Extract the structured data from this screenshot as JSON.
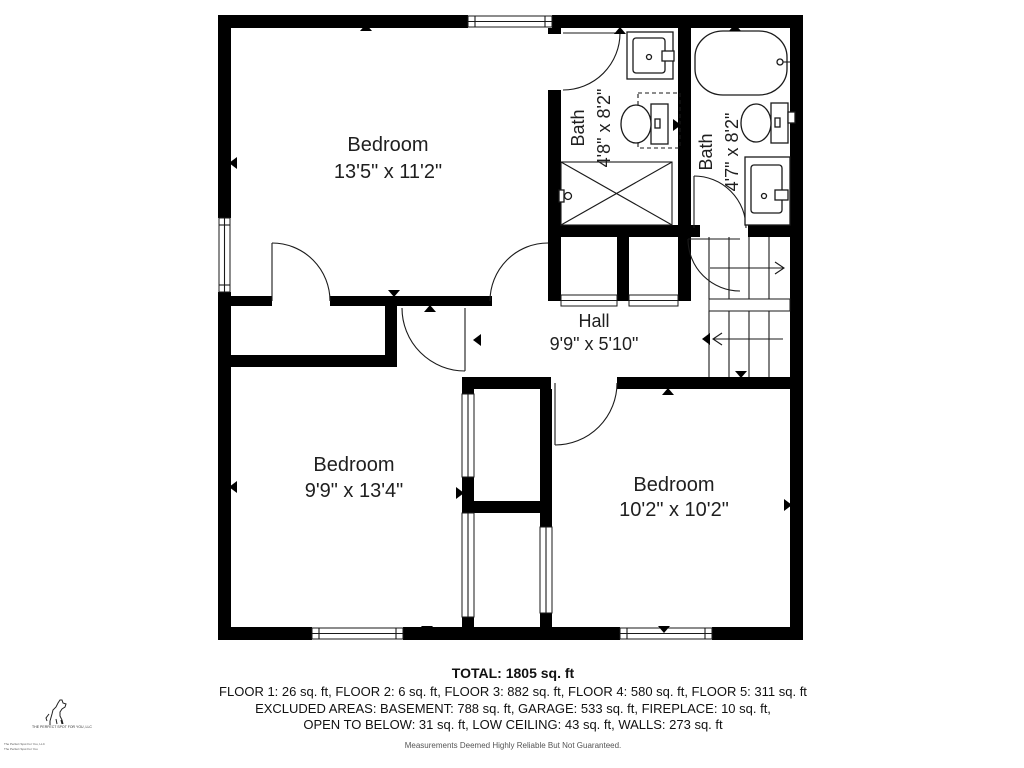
{
  "plan": {
    "rooms": [
      {
        "id": "bedroom-1",
        "name": "Bedroom",
        "dims": "13'5\" x 11'2\""
      },
      {
        "id": "bath-1",
        "name": "Bath",
        "dims": "4'8\" x 8'2\""
      },
      {
        "id": "bath-2",
        "name": "Bath",
        "dims": "4'7\" x 8'2\""
      },
      {
        "id": "hall",
        "name": "Hall",
        "dims": "9'9\" x 5'10\""
      },
      {
        "id": "bedroom-2",
        "name": "Bedroom",
        "dims": "9'9\" x 13'4\""
      },
      {
        "id": "bedroom-3",
        "name": "Bedroom",
        "dims": "10'2\" x 10'2\""
      }
    ],
    "summary": {
      "total": "TOTAL: 1805 sq. ft",
      "floors": "FLOOR 1: 26 sq. ft, FLOOR 2: 6 sq. ft, FLOOR 3: 882 sq. ft, FLOOR 4: 580 sq. ft, FLOOR 5: 311 sq. ft",
      "excluded_1": "EXCLUDED AREAS: BASEMENT: 788 sq. ft, GARAGE: 533 sq. ft, FIREPLACE: 10 sq. ft,",
      "excluded_2": "OPEN TO BELOW: 31 sq. ft, LOW CEILING: 43 sq. ft, WALLS: 273 sq. ft",
      "disclaimer": "Measurements Deemed Highly Reliable But Not Guaranteed."
    },
    "watermark": {
      "caption": "THE PERFECT SPOT FOR YOU, LLC",
      "corner_line_1": "The Perfect Spot For You, LLC",
      "corner_line_2": "The Perfect Spot For You"
    }
  }
}
